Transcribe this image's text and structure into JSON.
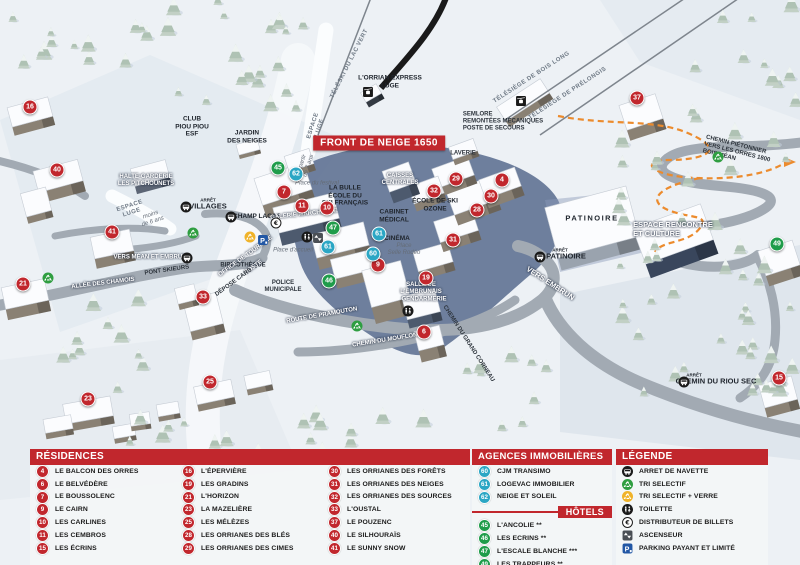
{
  "colors": {
    "res": "#c1272d",
    "hotel": "#1f9c4a",
    "agency": "#2ba6c4",
    "bar": "#c1272d"
  },
  "map": {
    "banner": {
      "text": "FRONT DE NEIGE 1650",
      "x": 379,
      "y": 143
    },
    "markers": [
      {
        "n": "16",
        "k": "res",
        "x": 30,
        "y": 107
      },
      {
        "n": "40",
        "k": "res",
        "x": 57,
        "y": 170
      },
      {
        "n": "41",
        "k": "res",
        "x": 112,
        "y": 232
      },
      {
        "n": "21",
        "k": "res",
        "x": 23,
        "y": 284
      },
      {
        "n": "33",
        "k": "res",
        "x": 203,
        "y": 297
      },
      {
        "n": "23",
        "k": "res",
        "x": 88,
        "y": 399
      },
      {
        "n": "25",
        "k": "res",
        "x": 210,
        "y": 382
      },
      {
        "n": "7",
        "k": "res",
        "x": 284,
        "y": 192
      },
      {
        "n": "11",
        "k": "res",
        "x": 302,
        "y": 206
      },
      {
        "n": "10",
        "k": "res",
        "x": 327,
        "y": 208
      },
      {
        "n": "9",
        "k": "res",
        "x": 378,
        "y": 265
      },
      {
        "n": "19",
        "k": "res",
        "x": 426,
        "y": 278
      },
      {
        "n": "6",
        "k": "res",
        "x": 424,
        "y": 332
      },
      {
        "n": "31",
        "k": "res",
        "x": 453,
        "y": 240
      },
      {
        "n": "32",
        "k": "res",
        "x": 434,
        "y": 191
      },
      {
        "n": "29",
        "k": "res",
        "x": 456,
        "y": 179
      },
      {
        "n": "28",
        "k": "res",
        "x": 477,
        "y": 210
      },
      {
        "n": "30",
        "k": "res",
        "x": 491,
        "y": 196
      },
      {
        "n": "4",
        "k": "res",
        "x": 502,
        "y": 180
      },
      {
        "n": "37",
        "k": "res",
        "x": 637,
        "y": 98
      },
      {
        "n": "15",
        "k": "res",
        "x": 779,
        "y": 378
      },
      {
        "n": "45",
        "k": "hotel",
        "x": 278,
        "y": 168
      },
      {
        "n": "47",
        "k": "hotel",
        "x": 333,
        "y": 228
      },
      {
        "n": "46",
        "k": "hotel",
        "x": 329,
        "y": 281
      },
      {
        "n": "49",
        "k": "hotel",
        "x": 777,
        "y": 244
      },
      {
        "n": "62",
        "k": "agency",
        "x": 296,
        "y": 174
      },
      {
        "n": "61",
        "k": "agency",
        "x": 328,
        "y": 247
      },
      {
        "n": "61",
        "k": "agency",
        "x": 379,
        "y": 234
      },
      {
        "n": "60",
        "k": "agency",
        "x": 373,
        "y": 254
      }
    ],
    "labels": [
      {
        "t": [
          "L'ORRIAN EXPRESS",
          "LUGE"
        ],
        "x": 390,
        "y": 82,
        "c": "dark"
      },
      {
        "t": [
          "TÉLÉSKI DU LAC VERT"
        ],
        "x": 350,
        "y": 64,
        "r": -63,
        "c": "roads"
      },
      {
        "t": [
          "ESPACE",
          "LUGE"
        ],
        "x": 317,
        "y": 127,
        "r": -72,
        "c": "roads"
      },
      {
        "t": [
          "à partir",
          "de 7 ans"
        ],
        "x": 306,
        "y": 165,
        "r": -72,
        "c": "its"
      },
      {
        "t": [
          "TÉLÉSIÈGE DE BOIS LONG"
        ],
        "x": 532,
        "y": 78,
        "r": -33,
        "c": "roads"
      },
      {
        "t": [
          "TÉLÉSIÈGE DE PRÉLONGIS"
        ],
        "x": 568,
        "y": 94,
        "r": -33,
        "c": "roads"
      },
      {
        "t": [
          "SEMLORE",
          "REMONTÉES MÉCANIQUES",
          "POSTE DE SECOURS"
        ],
        "x": 503,
        "y": 122,
        "c": "darks left"
      },
      {
        "t": [
          "JARDIN",
          "DES NEIGES"
        ],
        "x": 247,
        "y": 137,
        "c": "dark"
      },
      {
        "t": [
          "CLUB",
          "PIOU PIOU",
          "ESF"
        ],
        "x": 192,
        "y": 127,
        "c": "dark"
      },
      {
        "t": [
          "HALTE-GARDERIE",
          "LES PITCHOUNETS"
        ],
        "x": 146,
        "y": 181,
        "c": "whites"
      },
      {
        "t": [
          "ESPACE",
          "LUGE"
        ],
        "x": 131,
        "y": 210,
        "r": -18,
        "c": "roads"
      },
      {
        "t": [
          "moins",
          "de 6 ans"
        ],
        "x": 152,
        "y": 219,
        "r": -18,
        "c": "its"
      },
      {
        "t": [
          "ARRÊT"
        ],
        "x": 208,
        "y": 200,
        "c": "tinys"
      },
      {
        "t": [
          "VILLAGES"
        ],
        "x": 208,
        "y": 207,
        "c": "darkm"
      },
      {
        "t": [
          "CHAMP LACAS"
        ],
        "x": 257,
        "y": 217,
        "c": "dark"
      },
      {
        "t": [
          "ALLÉE DES CHAMOIS"
        ],
        "x": 103,
        "y": 284,
        "r": -7,
        "c": "whites"
      },
      {
        "t": [
          "VERS MÉAN ET EMBRUN"
        ],
        "x": 150,
        "y": 258,
        "c": "whites"
      },
      {
        "t": [
          "PONT SKIEURS"
        ],
        "x": 167,
        "y": 271,
        "r": -8,
        "c": "darks"
      },
      {
        "t": [
          "BIBLIOTHÈQUE"
        ],
        "x": 243,
        "y": 266,
        "c": "darks"
      },
      {
        "t": [
          "OFFICE DE TOURISME"
        ],
        "x": 246,
        "y": 257,
        "r": -36,
        "c": "whites"
      },
      {
        "t": [
          "POSTE"
        ],
        "x": 254,
        "y": 268,
        "r": -36,
        "c": "whites"
      },
      {
        "t": [
          "DÉPOSE CARS"
        ],
        "x": 234,
        "y": 283,
        "r": -36,
        "c": "darks"
      },
      {
        "t": [
          "POLICE",
          "MUNICIPALE"
        ],
        "x": 283,
        "y": 287,
        "c": "darks"
      },
      {
        "t": [
          "Place d'accueil"
        ],
        "x": 293,
        "y": 251,
        "c": "its"
      },
      {
        "t": [
          "Place du festival"
        ],
        "x": 317,
        "y": 184,
        "c": "its"
      },
      {
        "t": [
          "GALERIE MARCHANDE"
        ],
        "x": 304,
        "y": 215,
        "r": -6,
        "c": "whites"
      },
      {
        "t": [
          "LA BULLE",
          "ÉCOLE DU",
          "SKI FRANÇAIS"
        ],
        "x": 345,
        "y": 196,
        "c": "dark"
      },
      {
        "t": [
          "CAISSES",
          "CENTRALES"
        ],
        "x": 400,
        "y": 180,
        "c": "whites"
      },
      {
        "t": [
          "ÉCOLE DE SKI",
          "OZONE"
        ],
        "x": 435,
        "y": 205,
        "c": "dark"
      },
      {
        "t": [
          "CABINET",
          "MÉDICAL"
        ],
        "x": 394,
        "y": 216,
        "c": "dark"
      },
      {
        "t": [
          "CINÉMA"
        ],
        "x": 397,
        "y": 239,
        "c": "dark"
      },
      {
        "t": [
          "Place",
          "Selle Rodéo"
        ],
        "x": 404,
        "y": 250,
        "c": "its"
      },
      {
        "t": [
          "LAVERIE"
        ],
        "x": 463,
        "y": 154,
        "c": "darks"
      },
      {
        "t": [
          "SALLE DE",
          "L'EMBRUNAIS"
        ],
        "x": 421,
        "y": 289,
        "c": "whites"
      },
      {
        "t": [
          "GENDARMERIE"
        ],
        "x": 424,
        "y": 300,
        "c": "whites"
      },
      {
        "t": [
          "ROUTE DE PRAMOUTON"
        ],
        "x": 322,
        "y": 316,
        "r": -10,
        "c": "whites"
      },
      {
        "t": [
          "CHEMIN DU MOUFLON"
        ],
        "x": 385,
        "y": 341,
        "r": -9,
        "c": "whites"
      },
      {
        "t": [
          "CHEMIN DU GRAND CORNEAU"
        ],
        "x": 468,
        "y": 344,
        "r": 57,
        "c": "darks"
      },
      {
        "t": [
          "VERS EMBRUN"
        ],
        "x": 550,
        "y": 284,
        "r": 33,
        "c": "whitem"
      },
      {
        "t": [
          "PATINOIRE"
        ],
        "x": 592,
        "y": 219,
        "c": "darkm sp"
      },
      {
        "t": [
          "ARRÊT"
        ],
        "x": 560,
        "y": 250,
        "c": "tinys"
      },
      {
        "t": [
          "PATINOIRE"
        ],
        "x": 566,
        "y": 257,
        "c": "darkm"
      },
      {
        "t": [
          "ESPACE RENCONTRE",
          "ET CULTURE"
        ],
        "x": 673,
        "y": 230,
        "c": "whitem left"
      },
      {
        "t": [
          "CHEMIN PIÉTONNIER",
          "VERS LES ORRES 1800",
          "BOIS MÉAN"
        ],
        "x": 737,
        "y": 153,
        "r": 14,
        "c": "darks left"
      },
      {
        "t": [
          "ARRÊT"
        ],
        "x": 694,
        "y": 375,
        "c": "tinys"
      },
      {
        "t": [
          "CHEMIN DU RIOU SEC"
        ],
        "x": 716,
        "y": 382,
        "c": "darkm"
      }
    ],
    "icons": [
      {
        "n": "bus",
        "x": 186,
        "y": 207
      },
      {
        "n": "bus",
        "x": 231,
        "y": 217
      },
      {
        "n": "bus",
        "x": 187,
        "y": 258
      },
      {
        "n": "bus",
        "x": 540,
        "y": 257
      },
      {
        "n": "bus",
        "x": 684,
        "y": 382
      },
      {
        "n": "parking",
        "x": 263,
        "y": 240
      },
      {
        "n": "recycle-g",
        "x": 193,
        "y": 233
      },
      {
        "n": "recycle-g",
        "x": 48,
        "y": 278
      },
      {
        "n": "recycle-g",
        "x": 357,
        "y": 326
      },
      {
        "n": "recycle-g",
        "x": 718,
        "y": 157
      },
      {
        "n": "recycle-y",
        "x": 250,
        "y": 237
      },
      {
        "n": "wc",
        "x": 307,
        "y": 237
      },
      {
        "n": "wc",
        "x": 408,
        "y": 311
      },
      {
        "n": "elevator",
        "x": 318,
        "y": 238
      },
      {
        "n": "euro",
        "x": 276,
        "y": 223
      },
      {
        "n": "lift",
        "x": 368,
        "y": 92
      },
      {
        "n": "lift",
        "x": 521,
        "y": 101
      }
    ]
  },
  "legend": {
    "residences": {
      "title": "RÉSIDENCES",
      "items": [
        {
          "n": "4",
          "label": "LE BALCON DES ORRES"
        },
        {
          "n": "6",
          "label": "LE BELVÉDÈRE"
        },
        {
          "n": "7",
          "label": "LE BOUSSOLENC"
        },
        {
          "n": "9",
          "label": "LE CAIRN"
        },
        {
          "n": "10",
          "label": "LES CARLINES"
        },
        {
          "n": "11",
          "label": "LES CEMBROS"
        },
        {
          "n": "15",
          "label": "LES ÉCRINS"
        },
        {
          "n": "16",
          "label": "L'ÉPERVIÈRE"
        },
        {
          "n": "19",
          "label": "LES GRADINS"
        },
        {
          "n": "21",
          "label": "L'HORIZON"
        },
        {
          "n": "23",
          "label": "LA MAZELIÈRE"
        },
        {
          "n": "25",
          "label": "LES MÉLÈZES"
        },
        {
          "n": "28",
          "label": "LES ORRIANES DES BLÉS"
        },
        {
          "n": "29",
          "label": "LES ORRIANES DES CIMES"
        },
        {
          "n": "30",
          "label": "LES ORRIANES DES FORÊTS"
        },
        {
          "n": "31",
          "label": "LES ORRIANES DES NEIGES"
        },
        {
          "n": "32",
          "label": "LES ORRIANES DES SOURCES"
        },
        {
          "n": "33",
          "label": "L'OUSTAL"
        },
        {
          "n": "37",
          "label": "LE POUZENC"
        },
        {
          "n": "40",
          "label": "LE SILHOURAÏS"
        },
        {
          "n": "41",
          "label": "LE SUNNY SNOW"
        }
      ]
    },
    "agences": {
      "title": "AGENCES IMMOBILIÈRES",
      "items": [
        {
          "n": "60",
          "label": "CJM TRANSIMO"
        },
        {
          "n": "61",
          "label": "LOGEVAC IMMOBILIER"
        },
        {
          "n": "62",
          "label": "NEIGE ET SOLEIL"
        }
      ]
    },
    "hotels": {
      "title": "HÔTELS",
      "items": [
        {
          "n": "45",
          "label": "L'ANCOLIE **"
        },
        {
          "n": "46",
          "label": "LES ECRINS **"
        },
        {
          "n": "47",
          "label": "L'ESCALE BLANCHE ***"
        },
        {
          "n": "49",
          "label": "LES TRAPPEURS **"
        }
      ]
    },
    "legende": {
      "title": "LÉGENDE",
      "items": [
        {
          "icon": "bus",
          "label": "ARRET DE NAVETTE"
        },
        {
          "icon": "recycle-g",
          "label": "TRI SELECTIF"
        },
        {
          "icon": "recycle-y",
          "label": "TRI SELECTIF + VERRE"
        },
        {
          "icon": "wc",
          "label": "TOILETTE"
        },
        {
          "icon": "euro",
          "label": "DISTRIBUTEUR DE BILLETS"
        },
        {
          "icon": "elevator",
          "label": "ASCENSEUR"
        },
        {
          "icon": "parking",
          "label": "PARKING PAYANT ET LIMITÉ"
        }
      ]
    }
  }
}
